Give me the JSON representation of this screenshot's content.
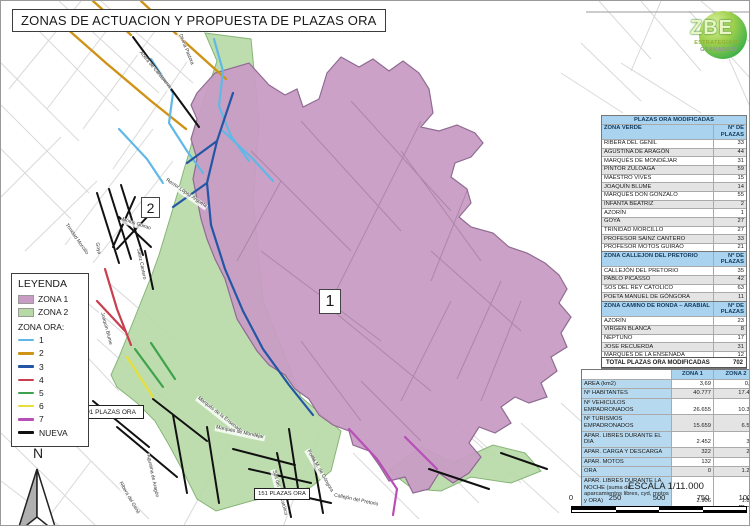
{
  "page": {
    "title": "ZONAS DE ACTUACION Y PROPUESTA DE PLAZAS ORA"
  },
  "logo": {
    "zbe": "ZBE",
    "line1": "ESTRATEGIA20",
    "line2": "GRANADA25"
  },
  "colors": {
    "zona1": "#c89cc4",
    "zona1_border": "#8f6b92",
    "zona2": "#b7d9a6",
    "zona2_border": "#86b577",
    "table_header": "#a9d3ee",
    "ora": {
      "1": "#5fb8e6",
      "2": "#cf9318",
      "3": "#2356a5",
      "4": "#c84050",
      "5": "#3fa34d",
      "6": "#e8de3a",
      "7": "#b84fb8",
      "nueva": "#111111"
    }
  },
  "legend": {
    "title": "LEYENDA",
    "zona1_label": "ZONA 1",
    "zona2_label": "ZONA 2",
    "ora_title": "ZONA ORA:",
    "ora_items": [
      {
        "label": "1",
        "key": "1"
      },
      {
        "label": "2",
        "key": "2"
      },
      {
        "label": "3",
        "key": "3"
      },
      {
        "label": "4",
        "key": "4"
      },
      {
        "label": "5",
        "key": "5"
      },
      {
        "label": "6",
        "key": "6"
      },
      {
        "label": "7",
        "key": "7"
      },
      {
        "label": "NUEVA",
        "key": "nueva"
      }
    ]
  },
  "map": {
    "zone1_number": "1",
    "zone2_number": "2",
    "plaza_badge_91": "91 PLAZAS ORA",
    "plaza_badge_151": "151 PLAZAS ORA",
    "north": "N",
    "street_labels": [
      {
        "text": "Acera de Canasteros",
        "x": 138,
        "y": 48,
        "rot": 50
      },
      {
        "text": "Divina Pastora",
        "x": 178,
        "y": 30,
        "rot": 68
      },
      {
        "text": "Rector López Argueta",
        "x": 164,
        "y": 176,
        "rot": 34
      },
      {
        "text": "Motos Guirao",
        "x": 120,
        "y": 216,
        "rot": 18
      },
      {
        "text": "Sainz Cantero",
        "x": 136,
        "y": 244,
        "rot": 78
      },
      {
        "text": "Trinidad Morcillo",
        "x": 64,
        "y": 220,
        "rot": 55
      },
      {
        "text": "Goya",
        "x": 95,
        "y": 238,
        "rot": 80
      },
      {
        "text": "Joaquín Blume",
        "x": 100,
        "y": 308,
        "rot": 75
      },
      {
        "text": "Marqués de la Ensenada",
        "x": 196,
        "y": 394,
        "rot": 38
      },
      {
        "text": "Marqués de Mondéjar",
        "x": 214,
        "y": 424,
        "rot": 12
      },
      {
        "text": "Agustina de Aragón",
        "x": 146,
        "y": 450,
        "rot": 78
      },
      {
        "text": "Ribera del Genil",
        "x": 118,
        "y": 478,
        "rot": 60
      },
      {
        "text": "Sos del Rey Católico",
        "x": 272,
        "y": 466,
        "rot": 75
      },
      {
        "text": "Poeta M. de Góngora",
        "x": 306,
        "y": 446,
        "rot": 60
      },
      {
        "text": "Callejón del Pretorio",
        "x": 332,
        "y": 492,
        "rot": 12
      }
    ]
  },
  "tables": {
    "modified": {
      "title": "PLAZAS ORA MODIFICADAS",
      "col1": "ZONA VERDE",
      "col2": "Nº DE PLAZAS",
      "rows": [
        [
          "RIBERA DEL GENIL",
          "33"
        ],
        [
          "AGUSTINA DE ARAGÓN",
          "44"
        ],
        [
          "MARQUÉS DE MONDÉJAR",
          "31"
        ],
        [
          "PINTOR ZULOAGA",
          "59"
        ],
        [
          "MAESTRO VIVES",
          "15"
        ],
        [
          "JOAQUÍN BLUME",
          "14"
        ],
        [
          "MARQUÉS DON GONZALO",
          "55"
        ],
        [
          "INFANTA BEATRIZ",
          "2"
        ],
        [
          "AZORÍN",
          "1"
        ],
        [
          "GOYA",
          "27"
        ],
        [
          "TRINIDAD MORCILLO",
          "27"
        ],
        [
          "PROFESOR SAINZ CANTERO",
          "33"
        ],
        [
          "PROFESOR MOTOS GUIRAO",
          "21"
        ],
        [
          "RECTOR LOPEZ ARGÜETA",
          "21"
        ],
        [
          "ACERA DE CANASTEROS",
          "36"
        ],
        [
          "ALMONA DE SAN JUAN DE DIOS",
          "12"
        ],
        [
          "DIVINA PASTORA",
          "29"
        ]
      ],
      "total_label": "TOTAL",
      "total_value": "460"
    },
    "pretorio": {
      "col1": "ZONA CALLEJON DEL PRETORIO",
      "col2": "Nº DE PLAZAS",
      "rows": [
        [
          "CALLEJÓN DEL PRETORIO",
          "35"
        ],
        [
          "PABLO PICASSO",
          "42"
        ],
        [
          "SOS DEL REY CATOLICO",
          "63"
        ],
        [
          "POETA MANUEL DE GÓNGORA",
          "11"
        ]
      ],
      "total_label": "TOTAL",
      "total_value": "151"
    },
    "ronda": {
      "col1": "ZONA CAMINO DE RONDA – ARABIAL",
      "col2": "Nº DE PLAZAS",
      "rows": [
        [
          "AZORÍN",
          "23"
        ],
        [
          "VIRGEN BLANCA",
          "8"
        ],
        [
          "NEPTUNO",
          "17"
        ],
        [
          "JOSE RECUERDA",
          "31"
        ],
        [
          "MARQUÉS DE LA ENSENADA",
          "12"
        ]
      ],
      "total_label": "TOTAL",
      "total_value": "91"
    },
    "grand_total": {
      "label": "TOTAL PLAZAS ORA MODIFICADAS",
      "value": "702"
    }
  },
  "stats": {
    "col_zona1": "ZONA 1",
    "col_zona2": "ZONA 2",
    "rows": [
      {
        "label": "AREA  (km2)",
        "z1": "3,69",
        "z2": "0,81"
      },
      {
        "label": "Nº HABITANTES",
        "z1": "40.777",
        "z2": "17.468"
      },
      {
        "label": "Nº VEHICULOS EMPADRONADOS",
        "z1": "26.655",
        "z2": "10.307"
      },
      {
        "label": "Nº TURISMOS EMPADRONADOS",
        "z1": "15.659",
        "z2": "6.534"
      },
      {
        "label": "APAR. LIBRES DURANTE EL DIA",
        "z1": "2.452",
        "z2": "324"
      },
      {
        "label": "APAR. CARGA Y DESCARGA",
        "z1": "322",
        "z2": "201"
      },
      {
        "label": "APAR. MOTOS",
        "z1": "132",
        "z2": "50"
      },
      {
        "label": "ORA",
        "z1": "0",
        "z2": "1.270"
      },
      {
        "label": "APAR. LIBRES DURANTE LA NOCHE (suma de aparcamientos libres, cyd, motos y ORA)",
        "z1": "2.906",
        "z2": "1.850"
      }
    ]
  },
  "scale": {
    "text": "ESCALA 1/11.000",
    "tick_labels": [
      "0",
      "250",
      "500",
      "750",
      "1000 m"
    ]
  }
}
